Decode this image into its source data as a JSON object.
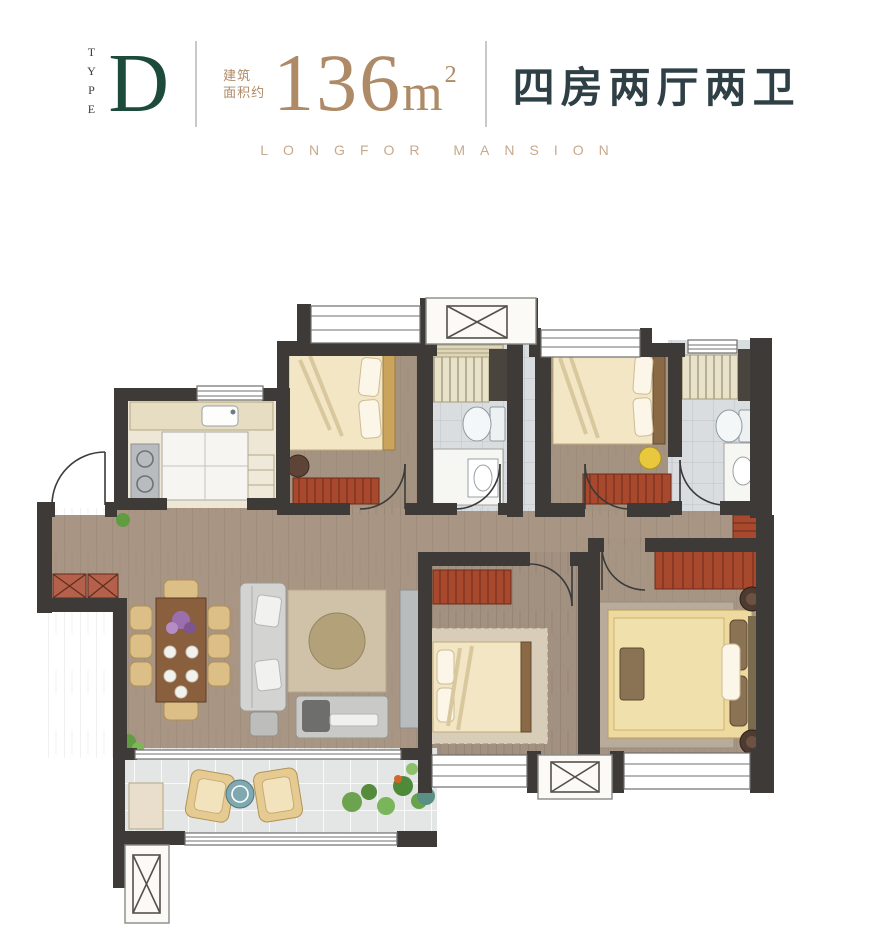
{
  "header": {
    "type_label": "TYPE",
    "type_value": "D",
    "area_prefix_line1": "建筑",
    "area_prefix_line2": "面积约",
    "area_number": "136",
    "area_unit": "m",
    "area_sup": "2",
    "layout_text": "四房两厅两卫",
    "subtitle": "LONGFOR MANSION"
  },
  "colors": {
    "accent_green": "#1c4a3b",
    "gold": "#ae8a67",
    "dark_text": "#2f3f46",
    "subtitle_gold": "#c8a98c",
    "wall": "#3e3a37",
    "wood": "#a89583",
    "kitchen_floor": "#eee7d6",
    "bath_floor": "#d9dde0",
    "tile_floor": "#e3e6e5",
    "red_furniture": "#a8492e",
    "bed_cream": "#f2e6c4",
    "bed_yellow": "#eeda9e",
    "sofa_gray": "#d3d3d1",
    "rug_beige": "#cfc2a9",
    "table_brown": "#8a5f3e",
    "chair_tan": "#dcbf86",
    "plant_green": "#6da34e"
  }
}
